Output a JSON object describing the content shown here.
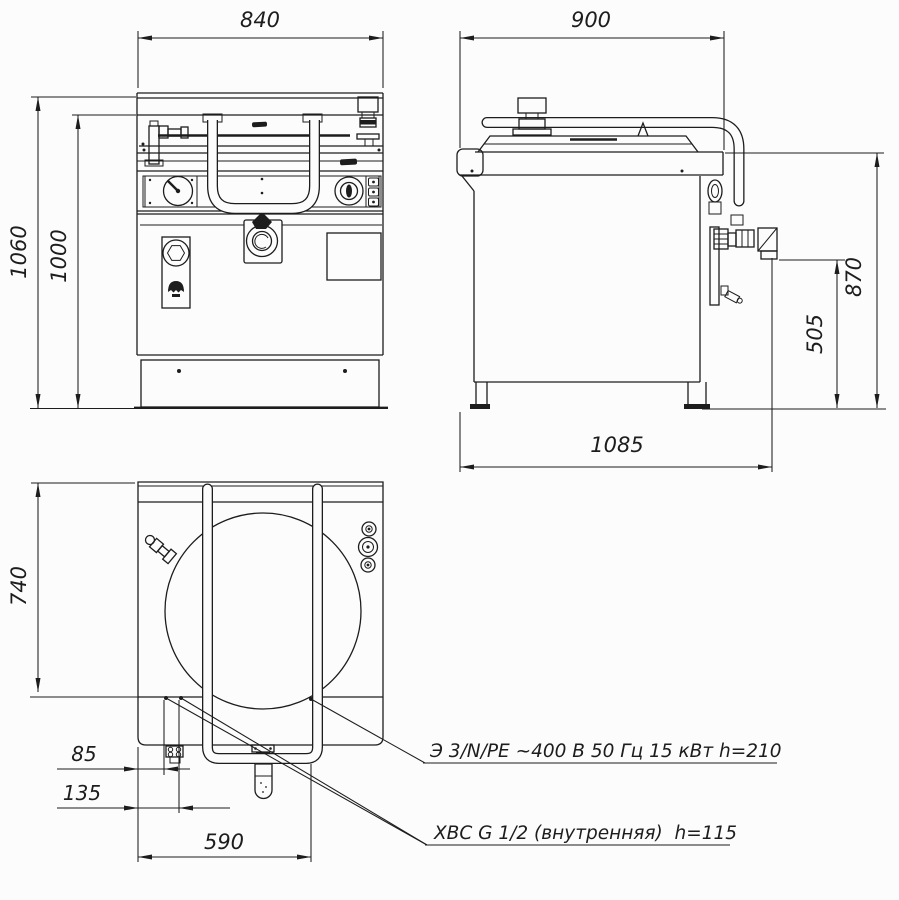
{
  "palette": {
    "line_color": "#1d1d1d",
    "background": "#fcfcfc"
  },
  "dimensions": {
    "front_width": "840",
    "side_depth": "900",
    "overall_height": "1060",
    "worktop_height": "1000",
    "faucet_height": "870",
    "drain_outlet_height": "505",
    "overall_depth": "1085",
    "top_view_depth": "740",
    "inlet_offset_small": "85",
    "inlet_offset_large": "135",
    "handle_span": "590"
  },
  "callouts": {
    "electrical": "Э 3/N/PE ~400 В 50 Гц 15 кВт h=210",
    "cold_water": "ХВС G 1/2 (внутренняя)  h=115"
  }
}
